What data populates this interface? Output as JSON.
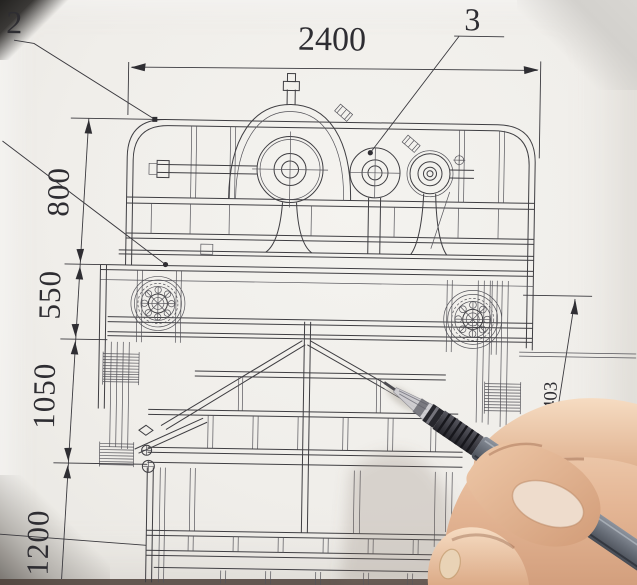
{
  "drawing": {
    "top_dimension": "2400",
    "left_dimensions": [
      "800",
      "550",
      "1050",
      "1200"
    ],
    "right_dimension": "1403",
    "callouts": [
      "2",
      "3"
    ]
  },
  "colors": {
    "paper": "#f0eeea",
    "ink": "#3f3e42",
    "pen_barrel": "#6b717b",
    "pen_grip": "#3d3d44",
    "skin": "#e9c4a4",
    "background_corner": "#c9c6c1"
  }
}
